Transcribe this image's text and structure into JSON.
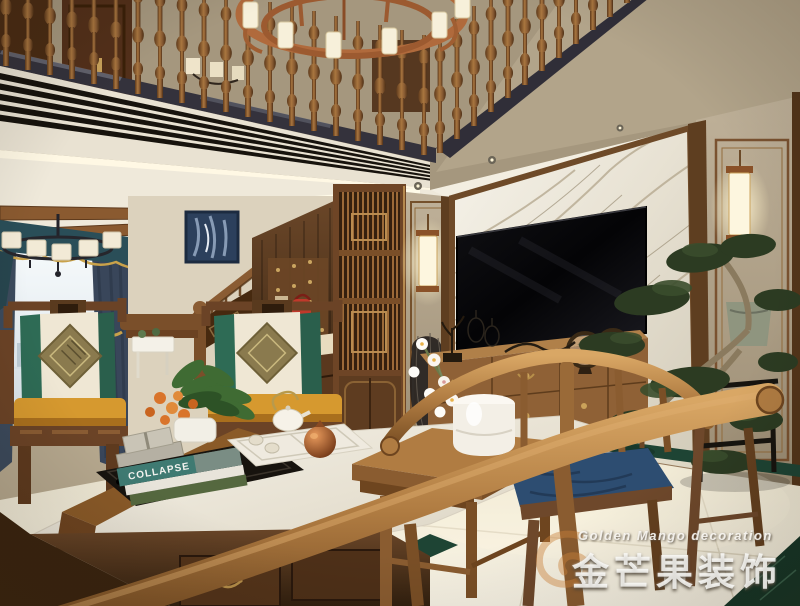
{
  "scene": {
    "type": "interior-rendering",
    "style": "new-chinese-style duplex living room",
    "objects": [
      "loft-balustrade",
      "copper-ring-chandelier",
      "linear-ac-vent",
      "ceiling-beams",
      "window-with-city-view",
      "teal-valance",
      "dark-curtains",
      "black-drum-chandelier",
      "staircase",
      "framed-abstract-art",
      "under-stair-coat-panel",
      "red-handbag",
      "wood-lattice-screen",
      "wall-sconces",
      "marble-tv-wall",
      "flat-screen-tv",
      "tv-console",
      "ring-fan-ornaments",
      "bonsai-pine-on-stand",
      "fabric-wall-panels",
      "chinese-armchairs",
      "diamond-pattern-cushions",
      "amber-seat-pads",
      "marble-top-coffee-table",
      "tea-tray-set",
      "copper-pomegranate",
      "book-stack",
      "plum-blossom-jar",
      "square-tea-table",
      "horseshoe-back-chair",
      "blue-seat-cushion",
      "cream-floor-tiles",
      "green-marble-inlay"
    ]
  },
  "watermark": {
    "line_en": "Golden Mango decoration",
    "line_zh": "金芒果装饰"
  },
  "book": {
    "title": "COLLAPSE"
  },
  "palette": {
    "wood": "#8a5c33",
    "walnut_dark": "#4a2e16",
    "copper": "#b06a3c",
    "marble_white": "#efeadd",
    "floor_cream": "#f2ecdb",
    "cushion_green": "#2e6b55",
    "cushion_amber": "#d6992f",
    "cushion_blue": "#2d4d71",
    "valance_teal": "#2a4e58",
    "green_marble": "#1e4434",
    "wall_beige": "#ab9d84"
  }
}
